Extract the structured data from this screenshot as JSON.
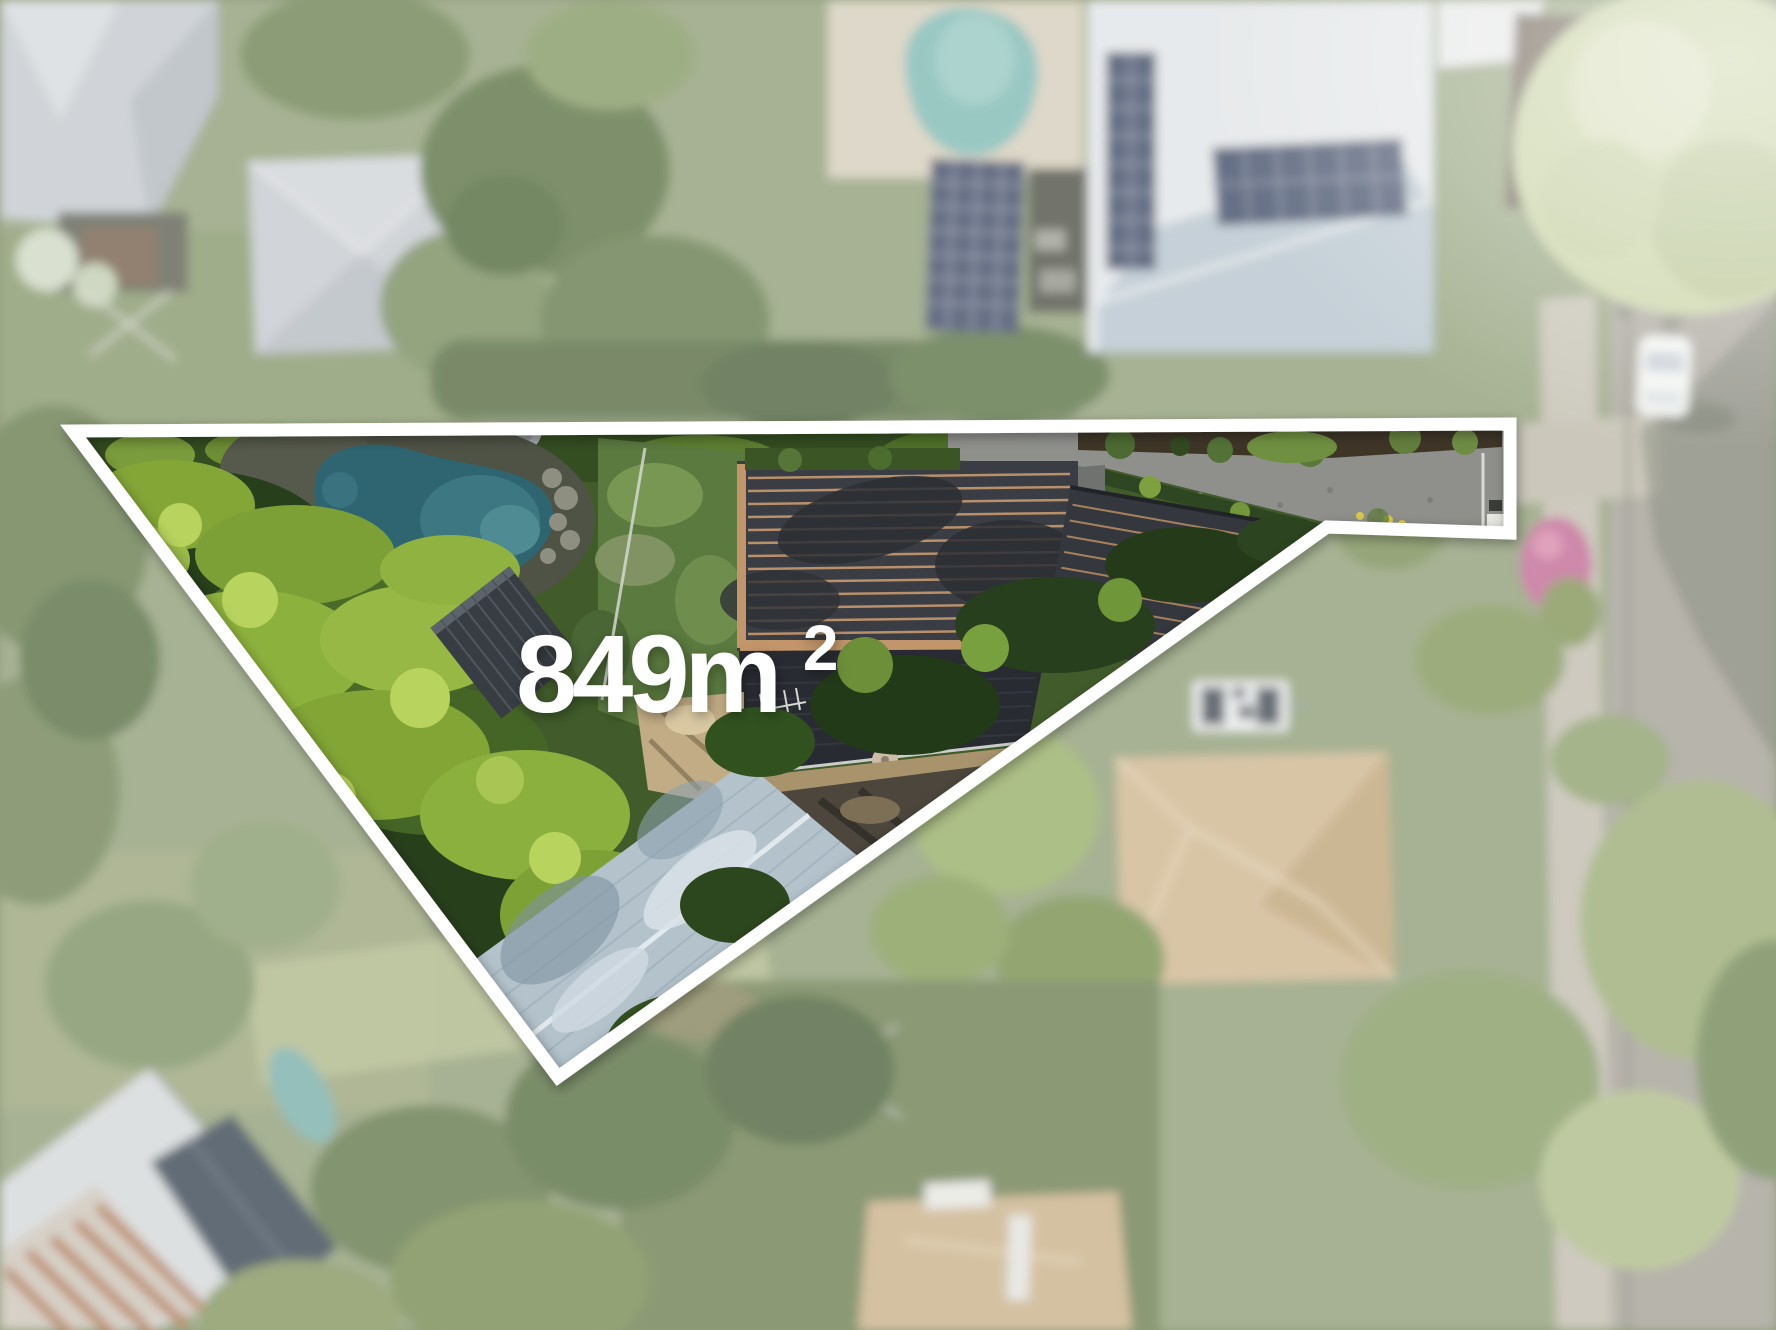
{
  "overlay": {
    "area_value": "849m",
    "area_exponent": "2",
    "area_full": "849m²"
  },
  "colors": {
    "boundary": "#ffffff",
    "area_label": "#ffffff",
    "property_pool": "#2e6570",
    "neighbor_pool": "#85bdb7",
    "property_lawn": "#5a7a3f",
    "main_roof_tiles": "#3a3d43",
    "metal_roof": "#b3c2cb",
    "solar_panels": "#49536d",
    "road": "#a9a59b",
    "concrete_driveway": "#8f908c",
    "foliage_bright": "#8db13d",
    "foliage_dark": "#27401b"
  }
}
